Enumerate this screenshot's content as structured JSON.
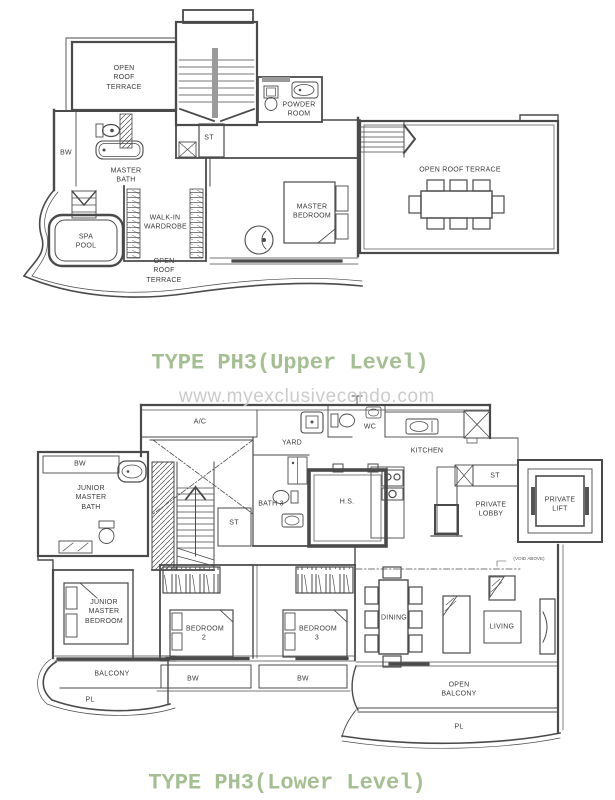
{
  "colors": {
    "wall": "#4a4a4a",
    "label": "#3a3a3a",
    "title_green": "#a4bf92",
    "watermark_gray": "#cbcbcb"
  },
  "watermark": "www.myexclusivecondo.com",
  "upper": {
    "title": "TYPE PH3(Upper Level)",
    "labels": {
      "open_roof_terrace_tl": "OPEN ROOF TERRACE",
      "powder_room": "POWDER ROOM",
      "st": "ST",
      "bw": "BW",
      "master_bath": "MASTER BATH",
      "walk_in_wardrobe": "WALK-IN WARDROBE",
      "spa_pool": "SPA POOL",
      "master_bedroom": "MASTER BEDROOM",
      "open_roof_terrace_right": "OPEN ROOF TERRACE",
      "open_roof_terrace_bottom": "OPEN ROOF TERRACE"
    }
  },
  "lower": {
    "title": "TYPE PH3(Lower Level)",
    "labels": {
      "ac": "A/C",
      "yard": "YARD",
      "wc": "WC",
      "kitchen": "KITCHEN",
      "bw_bath": "BW",
      "junior_master_bath": "JUNIOR MASTER BATH",
      "bath_3": "BATH 3",
      "hs": "H.S.",
      "st_stair": "ST",
      "st_lobby": "ST",
      "private_lobby": "PRIVATE LOBBY",
      "private_lift": "PRIVATE LIFT",
      "junior_master_bedroom": "JUNIOR MASTER BEDROOM",
      "bedroom_2": "BEDROOM 2",
      "bedroom_3": "BEDROOM 3",
      "dining": "DINING",
      "living": "LIVING",
      "balcony": "BALCONY",
      "pl_left": "PL",
      "bw_bedroom_2": "BW",
      "bw_bedroom_3": "BW",
      "open_balcony": "OPEN BALCONY",
      "pl_right": "PL",
      "void_above": "(VOID ABOVE)"
    }
  },
  "icons": [
    "staircase-icon",
    "toilet-icon",
    "sink-icon",
    "bathtub-icon",
    "spa-pool-icon",
    "steps-icon",
    "bed-icon",
    "armchair-icon",
    "dining-table-icon",
    "sofa-icon",
    "side-table-icon",
    "tv-console-icon",
    "stove-icon",
    "fridge-icon",
    "washer-icon",
    "kitchen-sink-icon",
    "shower-icon",
    "private-lift-icon",
    "ac-ledge-icon",
    "void-area-icon",
    "wardrobe-icon"
  ]
}
